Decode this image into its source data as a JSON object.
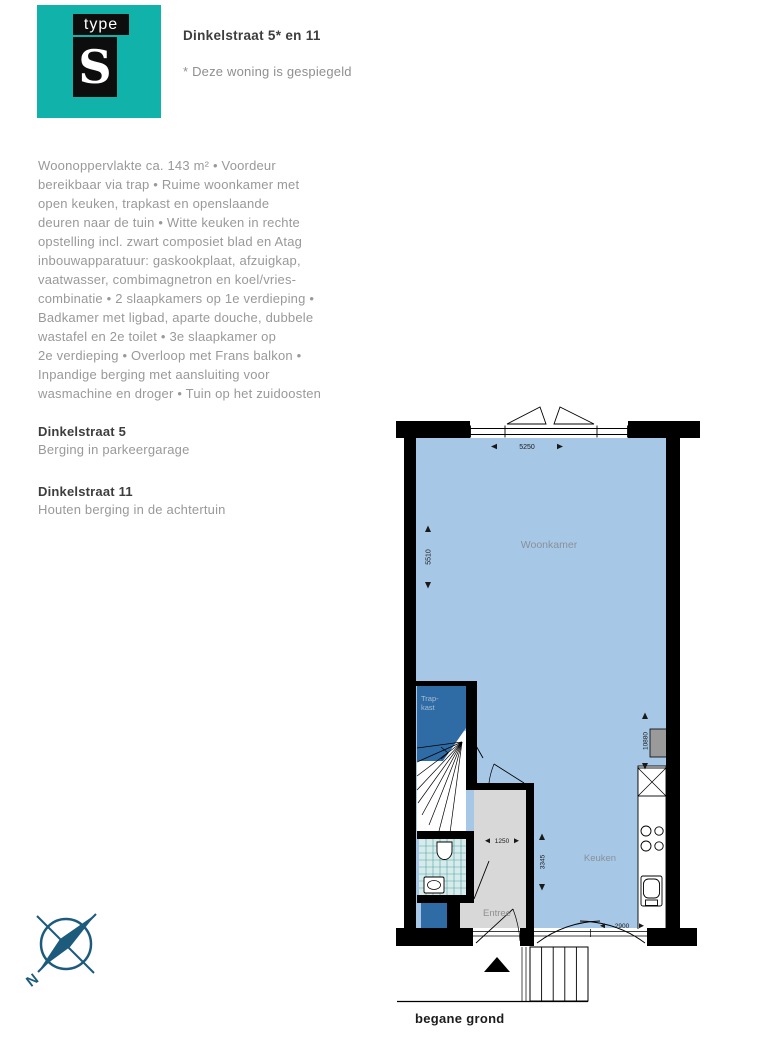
{
  "logo": {
    "type_label": "type",
    "s_label": "S"
  },
  "header": {
    "title": "Dinkelstraat 5* en 11",
    "note": "* Deze woning is gespiegeld"
  },
  "description": {
    "text": "Woonoppervlakte ca. 143 m² • Voordeur\nbereikbaar via trap • Ruime woonkamer met\nopen keuken, trapkast en openslaande\ndeuren naar de tuin • Witte keuken in rechte\nopstelling incl. zwart composiet blad en Atag\ninbouwapparatuur: gaskookplaat, afzuigkap,\nvaatwasser, combimagnetron en koel/vries-\ncombinatie • 2 slaapkamers op 1e verdieping •\nBadkamer met ligbad, aparte douche, dubbele\nwastafel en 2e toilet • 3e slaapkamer op\n2e verdieping • Overloop met Frans balkon •\nInpandige berging met aansluiting voor\nwasmachine en droger • Tuin op het zuidoosten"
  },
  "sections": [
    {
      "title": "Dinkelstraat 5",
      "text": "Berging in parkeergarage"
    },
    {
      "title": "Dinkelstraat 11",
      "text": "Houten berging in de achtertuin"
    }
  ],
  "floorplan": {
    "caption": "begane grond",
    "labels": {
      "woonkamer": "Woonkamer",
      "keuken": "Keuken",
      "entree": "Entree",
      "trapkast_line1": "Trap-",
      "trapkast_line2": "kast"
    },
    "dimensions": {
      "woonkamer_width": "5250",
      "woonkamer_depth": "5510",
      "entree_width": "1250",
      "keuken_depth": "3345",
      "tuindeuren_width": "2900",
      "totale_diepte": "10880"
    },
    "compass": {
      "north_label": "N"
    },
    "colors": {
      "accent_teal": "#10b2a9",
      "room_fill": "#a6c8e6",
      "closet_fill": "#2f6ca6",
      "tile_fill": "#d6ecea",
      "entree_fill": "#d8d8d8",
      "wall": "#000000",
      "compass": "#1d5b7d"
    }
  }
}
